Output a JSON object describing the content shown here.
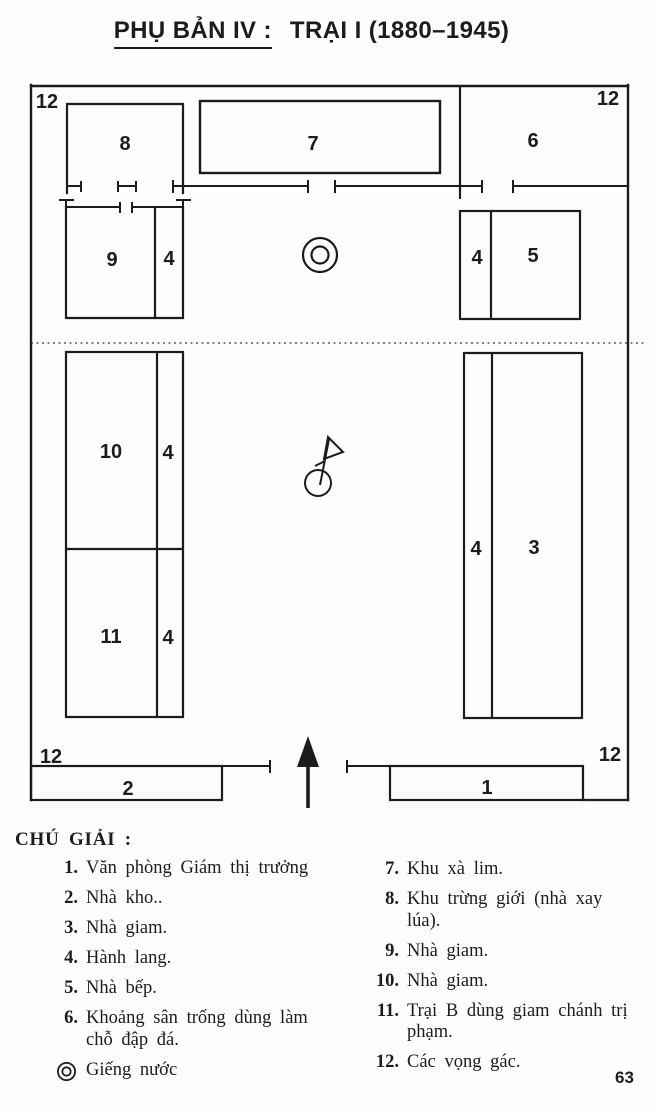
{
  "page": {
    "title_underlined": "PHỤ BẢN IV :",
    "title_rest": "TRẠI I (1880–1945)",
    "page_number": "63"
  },
  "plan": {
    "labels": {
      "tower_tl": "12",
      "tower_tr": "12",
      "tower_bl": "12",
      "tower_br": "12",
      "b8": "8",
      "b7": "7",
      "b6": "6",
      "b9": "9",
      "c9": "4",
      "c5": "4",
      "b5": "5",
      "b10": "10",
      "c10": "4",
      "b11": "11",
      "c11": "4",
      "c3": "4",
      "b3": "3",
      "b2": "2",
      "b1": "1"
    },
    "symbols": {
      "well": "well-icon",
      "flag": "flag-icon",
      "entrance_arrow": "entrance-arrow-icon"
    },
    "colors": {
      "ink": "#1c1c1c",
      "paper": "#fdfdfb"
    }
  },
  "legend": {
    "heading": "CHÚ GIẢI :",
    "left": [
      {
        "num": "1.",
        "text": "Văn phòng Giám thị trưởng"
      },
      {
        "num": "2.",
        "text": "Nhà kho.."
      },
      {
        "num": "3.",
        "text": "Nhà giam."
      },
      {
        "num": "4.",
        "text": "Hành lang."
      },
      {
        "num": "5.",
        "text": "Nhà bếp."
      },
      {
        "num": "6.",
        "text": "Khoảng sân trống dùng làm chỗ đập đá."
      }
    ],
    "well": {
      "icon": "well-icon",
      "text": "Giếng nước"
    },
    "right": [
      {
        "num": "7.",
        "text": "Khu xà lim."
      },
      {
        "num": "8.",
        "text": "Khu trừng giới (nhà xay lúa)."
      },
      {
        "num": "9.",
        "text": "Nhà giam."
      },
      {
        "num": "10.",
        "text": "Nhà giam."
      },
      {
        "num": "11.",
        "text": "Trại B dùng giam chánh trị phạm."
      },
      {
        "num": "12.",
        "text": "Các vọng gác."
      }
    ]
  }
}
